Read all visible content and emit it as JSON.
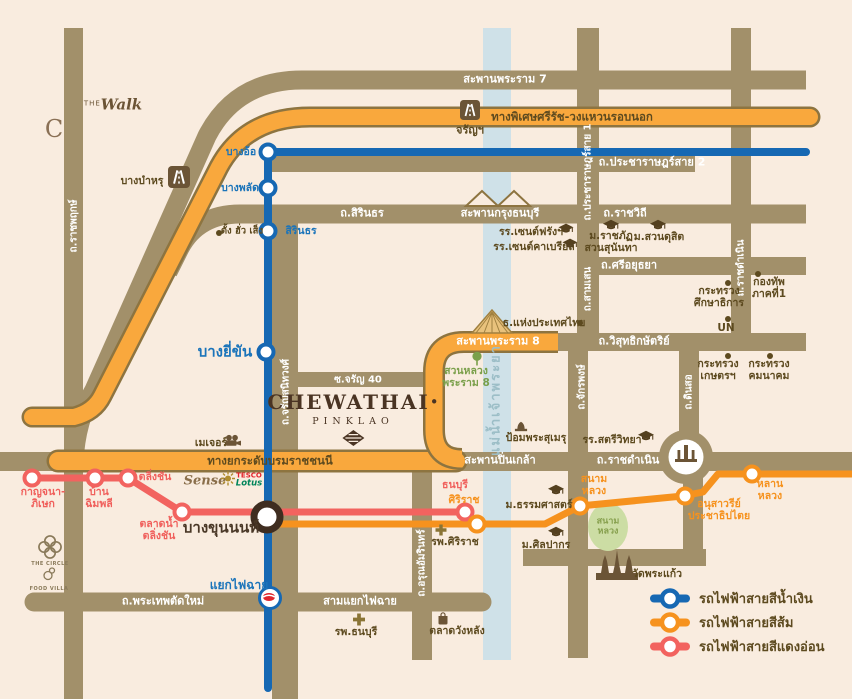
{
  "project": {
    "name": "CHEWATHAI",
    "dot": "•",
    "sub": "PINKLAO"
  },
  "river_label": "แม่น้ำเจ้าพระยา",
  "roads": {
    "rama7": "สะพานพระราม 7",
    "srirat": "ทางพิเศษศรีรัช-วงแหวนรอบนอก",
    "pracharat2": "ถ.ประชาราษฎร์สาย 2",
    "pracharat1": "ถ.ประชาราษฎร์สาย 1",
    "sirindhorn": "ถ.สิรินธร",
    "krungthon": "สะพานกรุงธนบุรี",
    "ratchawithi": "ถ.ราชวิถี",
    "sriayutthaya": "ถ.ศรีอยุธยา",
    "samsen": "ถ.สามเสน",
    "ratchadamnoen_nok": "ถ.ประชาราษฎร์สาย 1",
    "ratchadamnoen_v": "ถ.ราชดำเนิน",
    "ratchaphruek": "ถ.ราชพฤกษ์",
    "charansanitwong": "ถ.จรัญสนิทวงศ์",
    "soi_charan40": "ซ.จรัญ 40",
    "rama8": "สะพานพระราม 8",
    "wisutkasat": "ถ.วิสุทธิกษัตริย์",
    "chakphong": "ถ.จักรพงษ์",
    "dinso": "ถ.ดินสอ",
    "borom": "ทางยกระดับบรมราชชนนี",
    "pinklao": "สะพานปิ่นเกล้า",
    "ratchadamnoen_h": "ถ.ราชดำเนิน",
    "arun_amarin": "ถ.อรุณอัมรินทร์",
    "phrathep": "ถ.พระเทพตัดใหม่",
    "samyaek_faichai": "สามแยกไฟฉาย"
  },
  "stations": {
    "bang_o": "บางอ้อ",
    "bang_phlat": "บางพลัด",
    "sirindhorn": "สิรินธร",
    "bang_yikhan": "บางยี่ขัน",
    "yaek_faichai": "แยกไฟฉาย",
    "bang_khunnon": "บางขุนนนท์",
    "kanchana_1": "กาญจนา-",
    "kanchana_2": "ภิเษก",
    "ban_chimphli_1": "บ้าน",
    "ban_chimphli_2": "ฉิมพลี",
    "taling_chan": "ตลิ่งชัน",
    "talat_nam_1": "ตลาดน้ำ",
    "talat_nam_2": "ตลิ่งชัน",
    "thonburi": "ธนบุรี",
    "siriraj": "ศิริราช",
    "sanam_luang_1": "สนาม",
    "sanam_luang_2": "หลวง",
    "democracy_1": "อนุสาวรีย์",
    "democracy_2": "ประชาธิปไตย",
    "lan_luang_1": "หลาน",
    "lan_luang_2": "หลวง"
  },
  "pois": {
    "bang_bamru": "บางบำหรุ",
    "charan_gate": "จรัญฯ",
    "tang_hua_seng": "ตั้ง ฮั่ว เส็ง",
    "st_francis": "รร.เซนต์ฟรังฯ",
    "st_gabriel": "รร.เซนต์คาเบรียล",
    "sunandha_1": "ม.ราชภัฏ",
    "sunandha_2": "สวนสุนันทา",
    "suan_dusit": "ม.สวนดุสิต",
    "moe_1": "กระทรวง",
    "moe_2": "ศึกษาธิการ",
    "army_1": "กองทัพ",
    "army_2": "ภาคที่1",
    "un": "UN",
    "bot": "ธ.แห่งประเทศไทย",
    "moac_1": "กระทรวง",
    "moac_2": "เกษตรฯ",
    "mot_1": "กระทรวง",
    "mot_2": "คมนาคม",
    "fort": "ป้อมพระสุเมรุ",
    "satriwit": "รร.สตรีวิทยา",
    "rama8_park_1": "สวนหลวง",
    "rama8_park_2": "พระราม 8",
    "major": "เมเจอร์",
    "thammasat": "ม.ธรรมศาสตร์",
    "silpakorn": "ม.ศิลปากร",
    "wat_phra_kaew": "วัดพระแก้ว",
    "siriraj_hosp": "รพ.ศิริราช",
    "thonburi_hosp": "รพ.ธนบุรี",
    "wang_lang": "ตลาดวังหลัง",
    "sanam_park_1": "สนาม",
    "sanam_park_2": "หลวง"
  },
  "logos": {
    "the_walk_the": "THE",
    "the_walk": "Walk",
    "central_c": "C",
    "sense": "Sense",
    "tesco": "TESCO",
    "lotus": "Lotus",
    "the_circle": "THE CIRCLE",
    "food_villa": "FOOD VILLA"
  },
  "legend": {
    "blue": "รถไฟฟ้าสายสีน้ำเงิน",
    "orange": "รถไฟฟ้าสายสีส้ม",
    "red": "รถไฟฟ้าสายสีแดงอ่อน"
  },
  "colors": {
    "blue_line": "#1668b3",
    "orange_line": "#f6921e",
    "red_line": "#f2635f",
    "road": "#a2906a",
    "orange_road": "#f9a83d",
    "river": "#cfe1e8",
    "background": "#f9ecdf"
  }
}
